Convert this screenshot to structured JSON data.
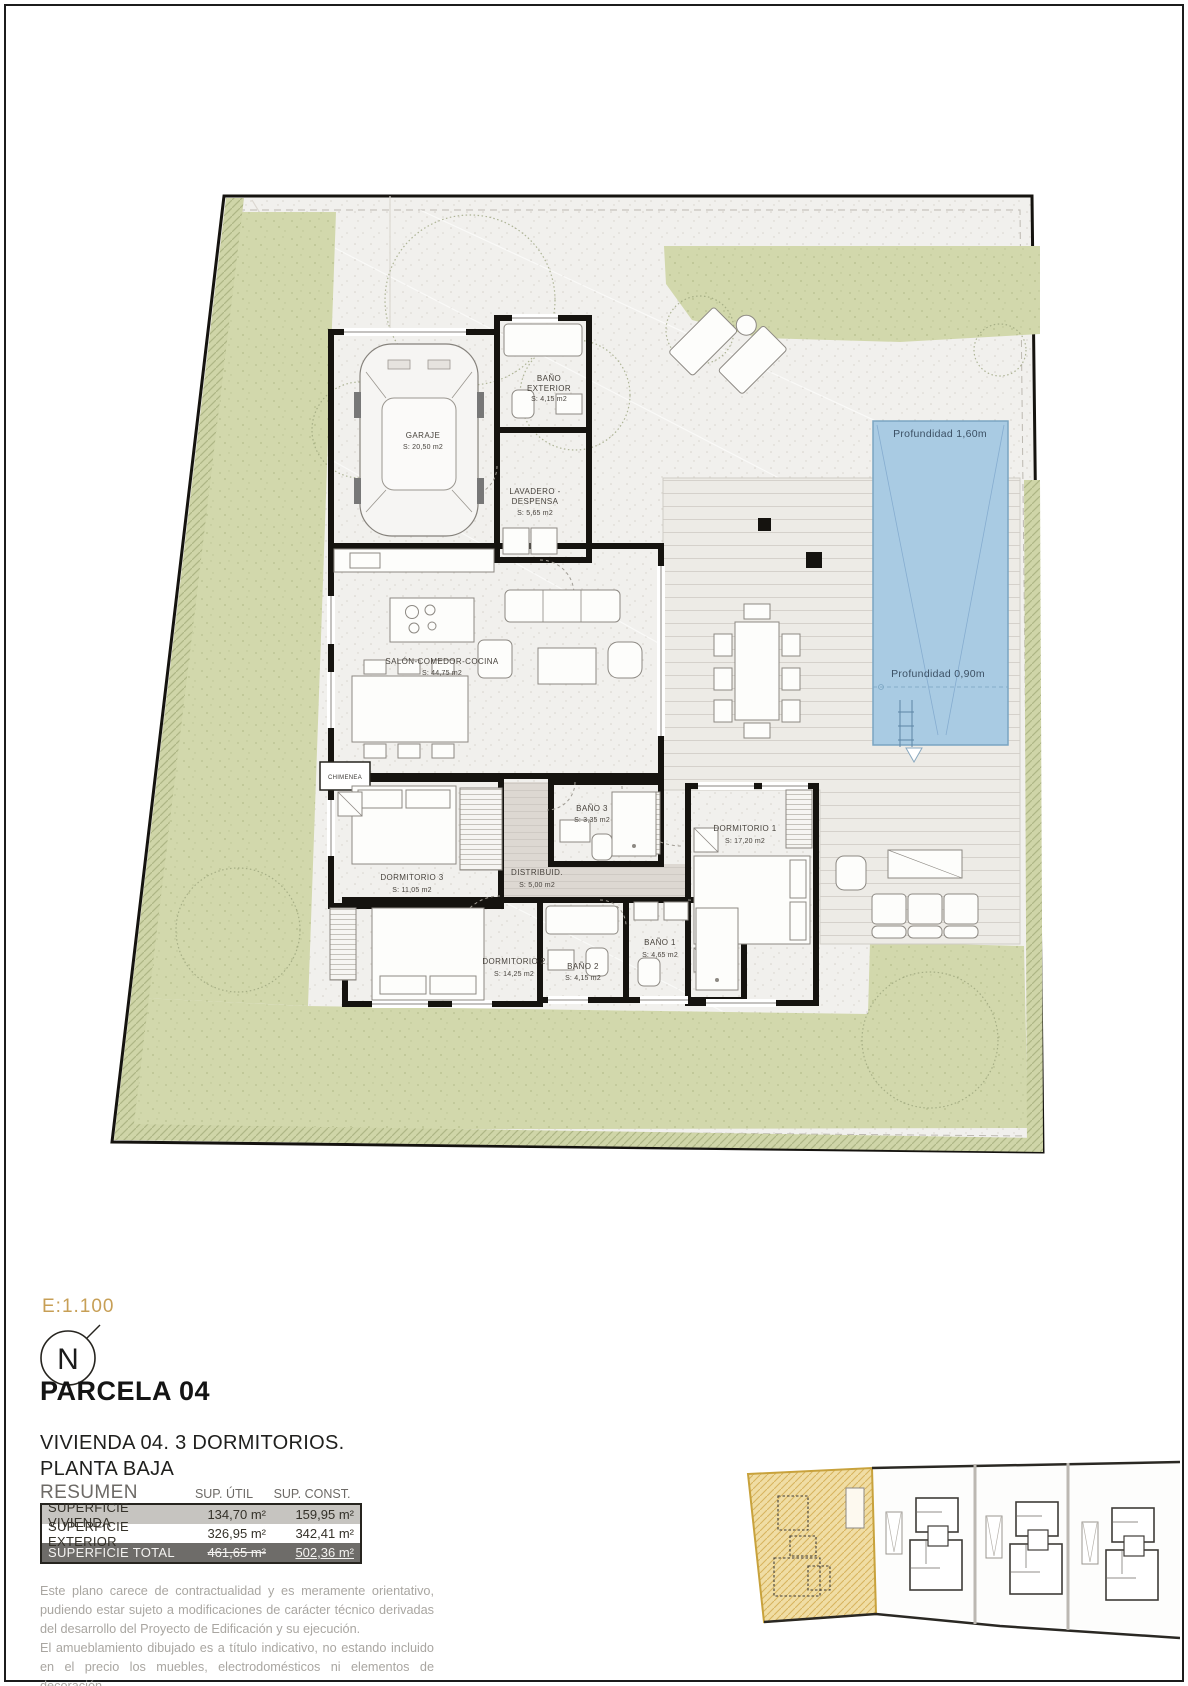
{
  "sheet": {
    "scale": "E:1.100",
    "north_letter": "N",
    "title": "PARCELA 04",
    "subtitle1": "VIVIENDA 04. 3 DORMITORIOS.",
    "subtitle2": "PLANTA BAJA"
  },
  "plan": {
    "rooms": {
      "garaje": {
        "name": "GARAJE",
        "area": "S: 20,50 m2"
      },
      "bano_exterior": {
        "name1": "BAÑO",
        "name2": "EXTERIOR",
        "area": "S: 4,15 m2"
      },
      "lavadero": {
        "name1": "LAVADERO -",
        "name2": "DESPENSA",
        "area": "S: 5,65 m2"
      },
      "salon": {
        "name": "SALÓN-COMEDOR-COCINA",
        "area": "S: 44,75 m2"
      },
      "chimenea": {
        "name": "CHIMENEA"
      },
      "dormitorio3": {
        "name": "DORMITORIO 3",
        "area": "S: 11,05 m2"
      },
      "bano3": {
        "name": "BAÑO 3",
        "area": "S: 3,35 m2"
      },
      "distribuidor": {
        "name": "DISTRIBUID.",
        "area": "S: 5,00 m2"
      },
      "dormitorio1": {
        "name": "DORMITORIO 1",
        "area": "S: 17,20 m2"
      },
      "bano1": {
        "name": "BAÑO 1",
        "area": "S: 4,65 m2"
      },
      "dormitorio2": {
        "name": "DORMITORIO 2",
        "area": "S: 14,25 m2"
      },
      "bano2": {
        "name": "BAÑO 2",
        "area": "S: 4,15 m2"
      }
    },
    "pool": {
      "depth_deep": "Profundidad 1,60m",
      "depth_shallow": "Profundidad 0,90m"
    }
  },
  "summary": {
    "heading": "RESUMEN SUPERFICIES",
    "col_util": "SUP. ÚTIL",
    "col_const": "SUP. CONST.",
    "rows": [
      {
        "label": "SUPERFICIE VIVIENDA",
        "util": "134,70 m²",
        "const": "159,95 m²"
      },
      {
        "label": "SUPERFICIE EXTERIOR",
        "util": "326,95 m²",
        "const": "342,41 m²"
      },
      {
        "label": "SUPERFICIE TOTAL",
        "util": "461,65 m²",
        "const": "502,36 m²"
      }
    ]
  },
  "disclaimer": {
    "p1": "Este plano carece de contractualidad y es meramente orientativo, pudiendo estar sujeto a modificaciones de carácter técnico derivadas del desarrollo del Proyecto de Edificación y su ejecución.",
    "p2": "El amueblamiento dibujado es a título indicativo, no estando incluido en el precio los muebles, electrodomésticos ni elementos de decoración.",
    "p3": "Solo se incluye los elementos incluidos en la memoria del Proyecto visado."
  },
  "colors": {
    "pool": "#a9cbe3",
    "grass": "#d2d8ac",
    "highlight_parcel": "#f0dda4",
    "accent_scale": "#c79f56"
  }
}
